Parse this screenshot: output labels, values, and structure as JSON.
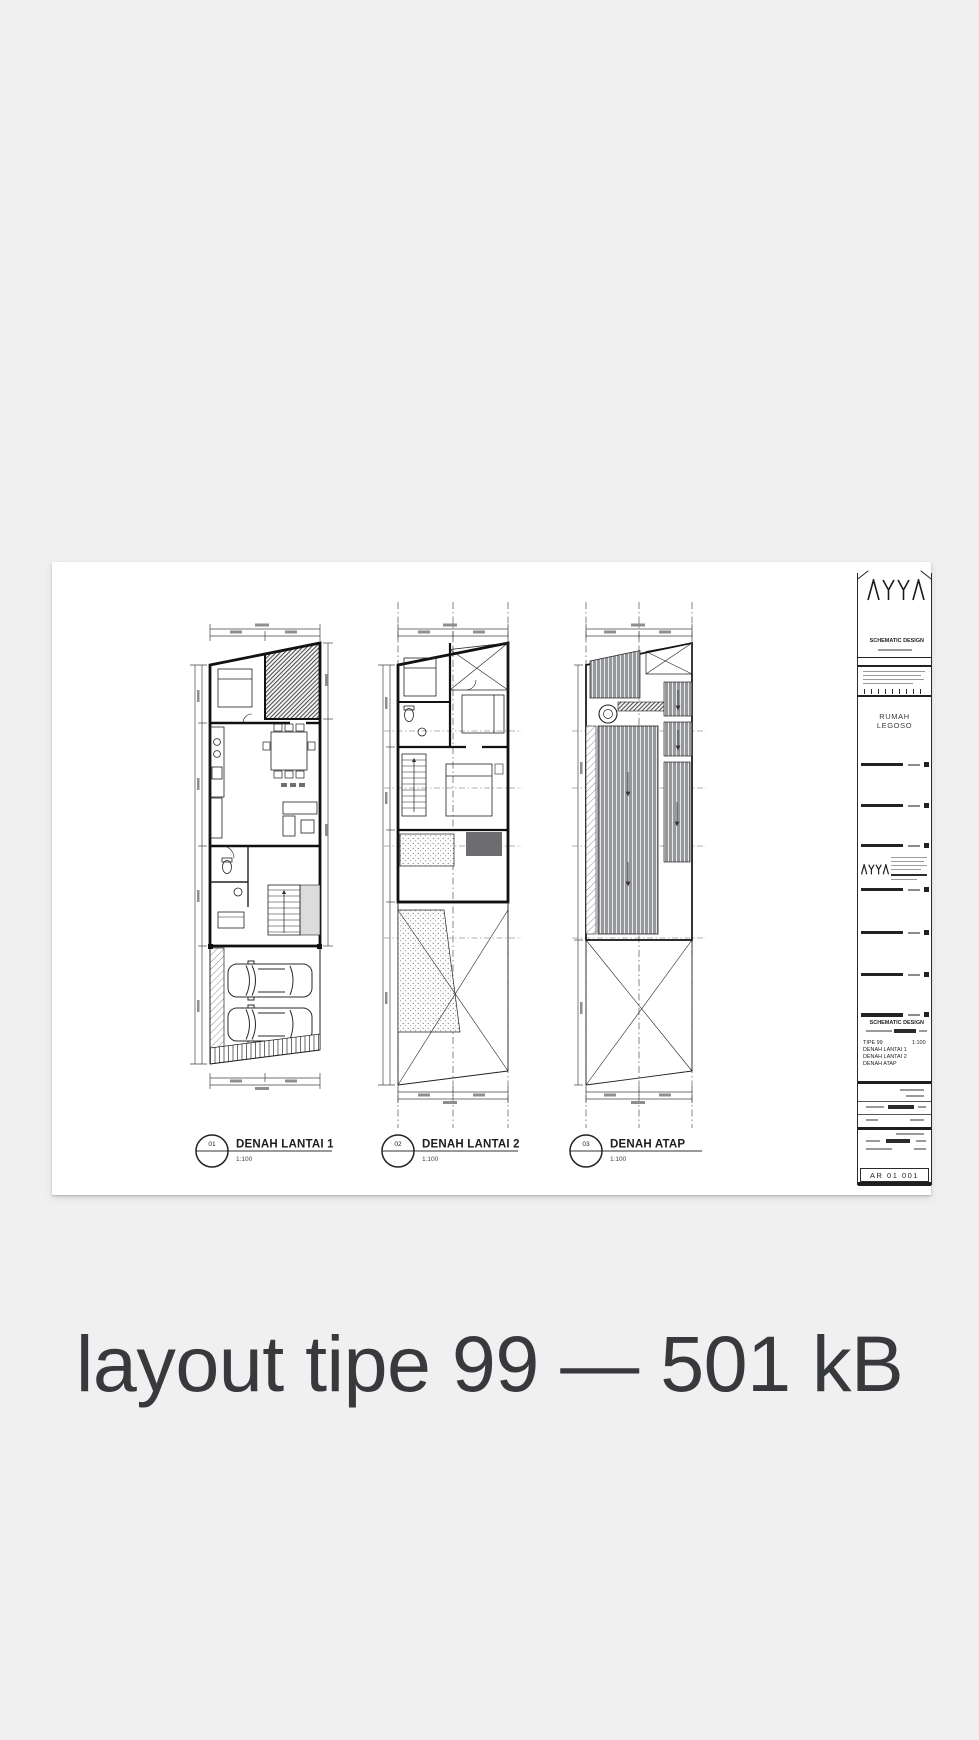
{
  "caption": "layout tipe 99 — 501 kB",
  "titleblock": {
    "logo": "AYYA",
    "phase": "SCHEMATIC DESIGN",
    "project_name_line1": "RUMAH",
    "project_name_line2": "LEGOSO",
    "firm": "AYYA",
    "info_heading": "SCHEMATIC DESIGN",
    "type_label": "TIPE 99",
    "scale": "1:100",
    "sheets": [
      "DENAH LANTAI 1",
      "DENAH LANTAI 2",
      "DENAH ATAP"
    ],
    "sheet_no": "AR 01 001"
  },
  "plans": [
    {
      "num": "01",
      "label": "DENAH LANTAI 1",
      "scale": "1:100"
    },
    {
      "num": "02",
      "label": "DENAH LANTAI 2",
      "scale": "1:100"
    },
    {
      "num": "03",
      "label": "DENAH ATAP",
      "scale": "1:100"
    }
  ],
  "colors": {
    "background": "#f0f0f1",
    "sheet": "#ffffff",
    "ink": "#1d1d1f",
    "caption_text": "#37393c",
    "roof_fill": "#97989b",
    "hatch_dark": "#2e2e30"
  }
}
